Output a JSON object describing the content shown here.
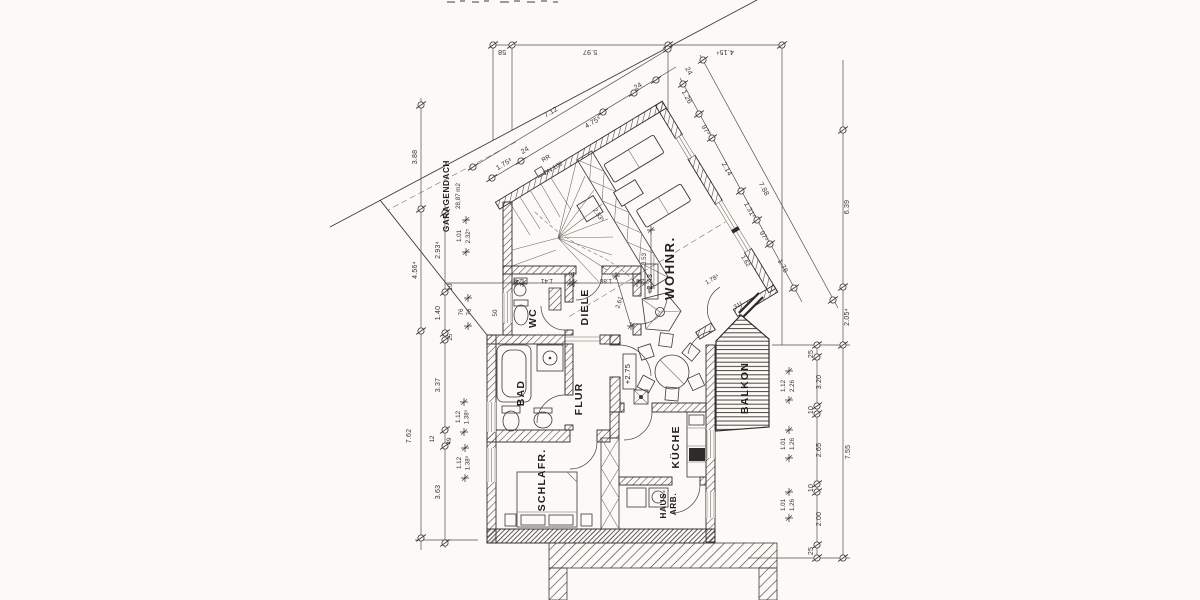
{
  "meta": {
    "type": "architectural floor plan (scan)",
    "language": "de"
  },
  "rooms": {
    "wc": "WC",
    "diele": "DIELE",
    "wohnraum": "WOHNR.",
    "bad": "BAD",
    "flur": "FLUR",
    "kueche": "KÜCHE",
    "schlafzimmer": "SCHLAFR.",
    "hausarbeit_line1": "HAUS-",
    "hausarbeit_line2": "ARB.",
    "balkon": "BALKON",
    "garagendach_line1": "GARAGENDACH",
    "garagendach_line2": "28,87 m2"
  },
  "levels": {
    "wohnraum": "+2.43",
    "essplatz": "+2.75"
  },
  "annotations": {
    "rr_line1": "RR",
    "rr_line2": "DN 100"
  },
  "dimensions": {
    "top": {
      "d58": "58",
      "d597": "5.97",
      "d415": "4.15⁴"
    },
    "nw": {
      "d712": "7.12",
      "d4755": "4.75⁵",
      "d24a": "24",
      "d1753": "1.75³",
      "d24b": "24"
    },
    "ne": {
      "c126": "1.26",
      "c97a": "97²",
      "c214": "2.14",
      "c1312": "1.31²",
      "c97b": "97²",
      "c176": "1.76",
      "c24": "24",
      "total": "7.88"
    },
    "right": {
      "d639": "6.39",
      "d2054": "2.05⁴",
      "d755": "7.55",
      "c25a": "25",
      "c320": "3.20",
      "c10a": "10",
      "c265": "2.65",
      "c10b": "10",
      "c200": "2.00",
      "c25b": "25",
      "w112": "1.12",
      "w226": "2.26",
      "w101a": "1.01",
      "w126a": "1.26",
      "w101b": "1.01",
      "w126b": "1.26",
      "d1784": "1.78⁴",
      "d162": "1.62",
      "d312": "31²"
    },
    "left": {
      "d388": "3.88",
      "d4564": "4.56⁴",
      "d762": "7.62",
      "d2934": "2.93⁴",
      "d10": "10",
      "d140": "1.40",
      "d25": "25",
      "d337": "3.37",
      "d12": "12",
      "d49": "49",
      "d363": "3.63",
      "w101": "1.01",
      "w2325": "2.32⁵",
      "w76a": "76",
      "w76b": "76",
      "w112a": "1.12",
      "w1385a": "1.38⁵",
      "w112b": "1.12",
      "w1385b": "1.38⁵",
      "d50": "50"
    },
    "inner": {
      "c24a": "24",
      "c141": "1.41",
      "c10": "10",
      "c188": "1.88",
      "c24b": "24",
      "d2535": "2.53⁵",
      "d353": "3.53",
      "d261": "2.61"
    }
  }
}
